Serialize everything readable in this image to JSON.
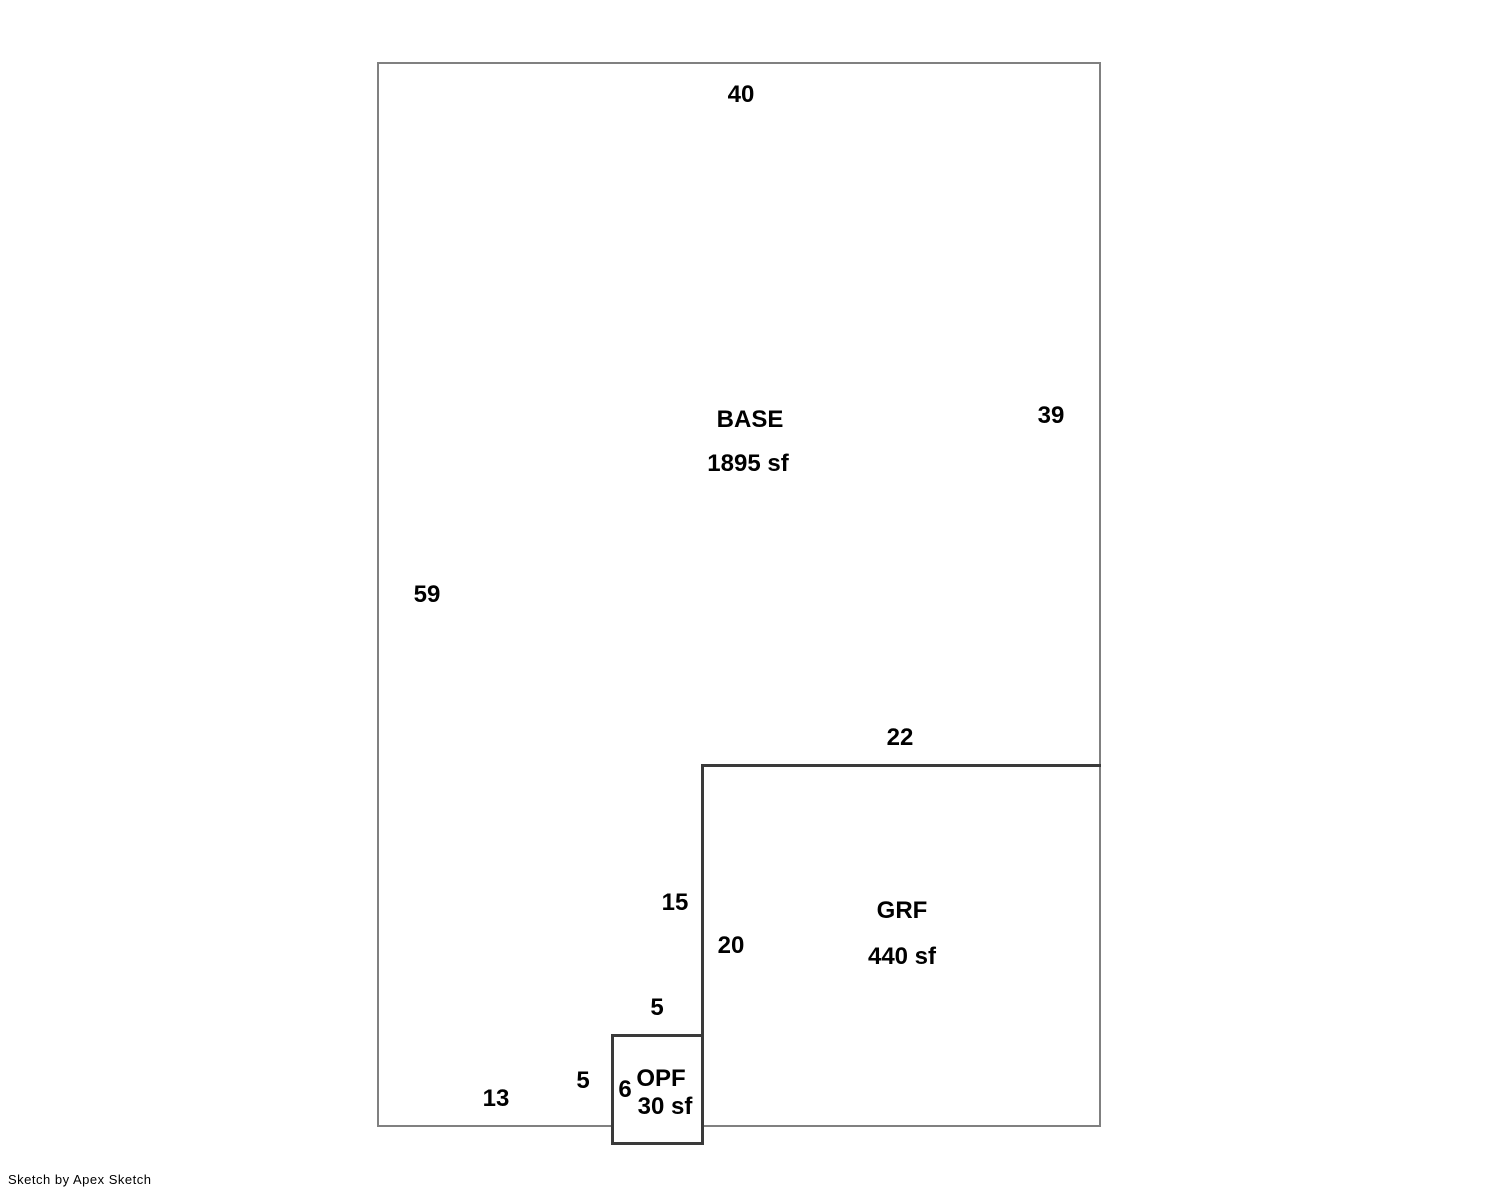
{
  "sketch": {
    "areas": {
      "base": {
        "name": "BASE",
        "size": "1895 sf"
      },
      "grf": {
        "name": "GRF",
        "size": "440 sf"
      },
      "opf": {
        "name": "OPF",
        "size": "30 sf"
      }
    },
    "dimensions": {
      "base_top": "40",
      "base_right": "39",
      "base_left": "59",
      "grf_top": "22",
      "divider_base_side": "15",
      "grf_left": "20",
      "opf_top": "5",
      "opf_left_inner": "5",
      "opf_height": "6",
      "base_bottom_left": "13"
    }
  },
  "footer": {
    "credit": "Sketch by Apex Sketch"
  },
  "colors": {
    "outer_wall": "#808080",
    "inner_wall": "#3a3a3a",
    "text": "#000000",
    "background": "#ffffff"
  }
}
